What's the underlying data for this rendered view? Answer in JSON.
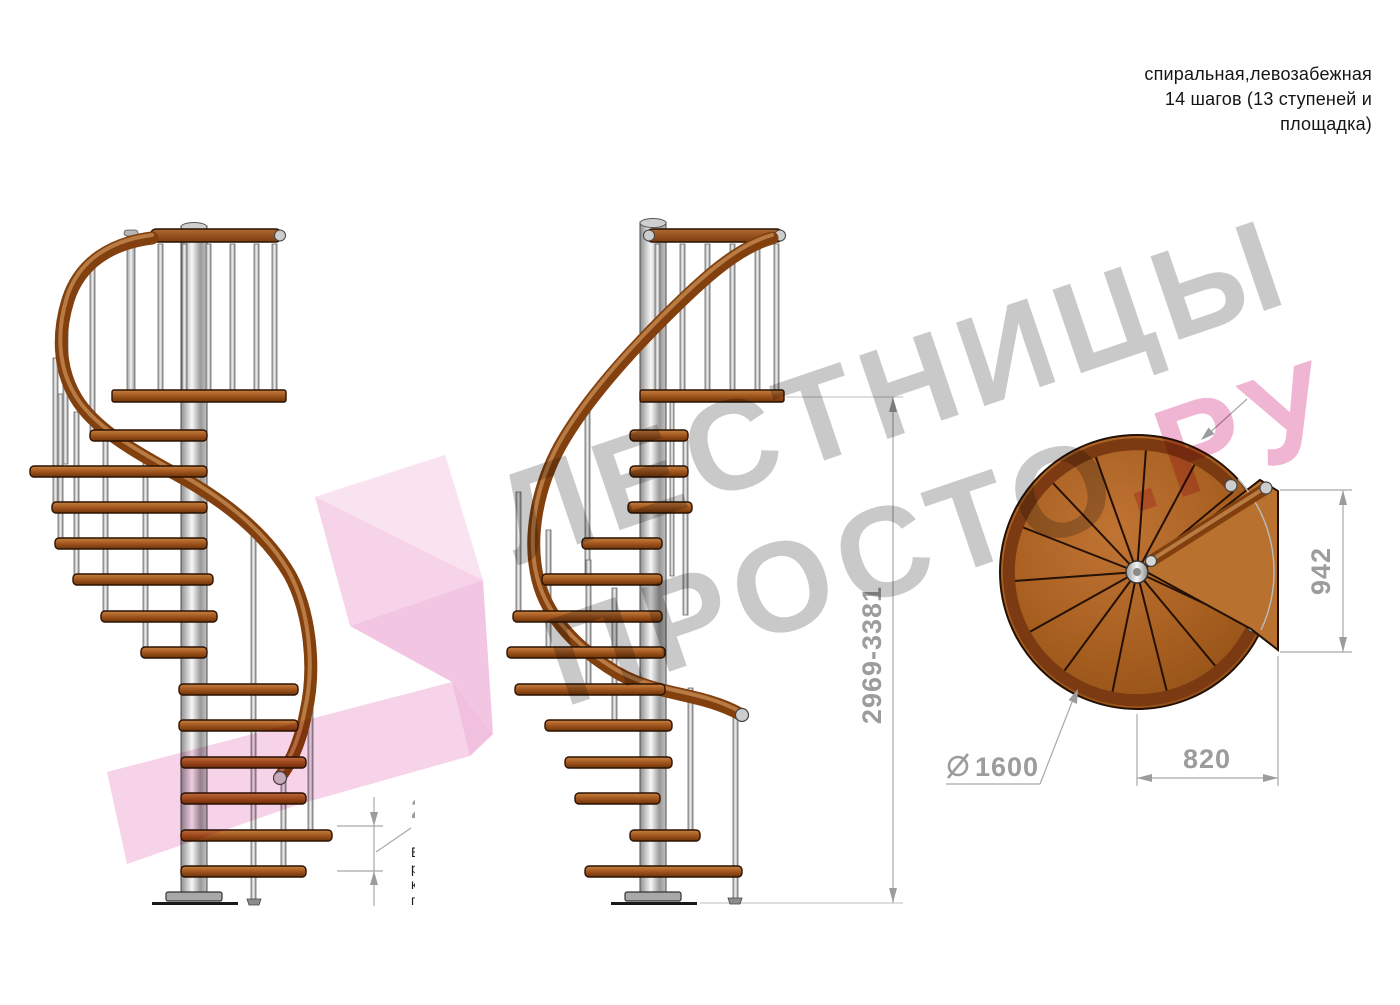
{
  "title_block": {
    "line1": "спиральная,левозабежная",
    "line2": "14 шагов (13 ступеней и",
    "line3": "площадка)"
  },
  "watermark": {
    "brand_line1": "ЛЕСТНИЦЫ",
    "brand_line2": "ПРОСТО",
    "brand_suffix": ".РУ"
  },
  "dimensions": {
    "total_height_range": "2969-3381",
    "step_height_range": "212-242",
    "platform_length": "942",
    "platform_offset": "820",
    "diameter_value": "1600"
  },
  "note": {
    "lines": [
      "Высота шага",
      "регулируется",
      "композитными",
      "проставками"
    ]
  },
  "colors": {
    "dimension_gray": "#9c9c9c",
    "watermark_gray": "#c9c9c9",
    "watermark_pink": "#efb5d2",
    "logo_pink": "#f6d3e9",
    "wood_brown": "#9c521b",
    "rail_brown": "#8a4216",
    "steel_gray": "#d8d8d8"
  }
}
